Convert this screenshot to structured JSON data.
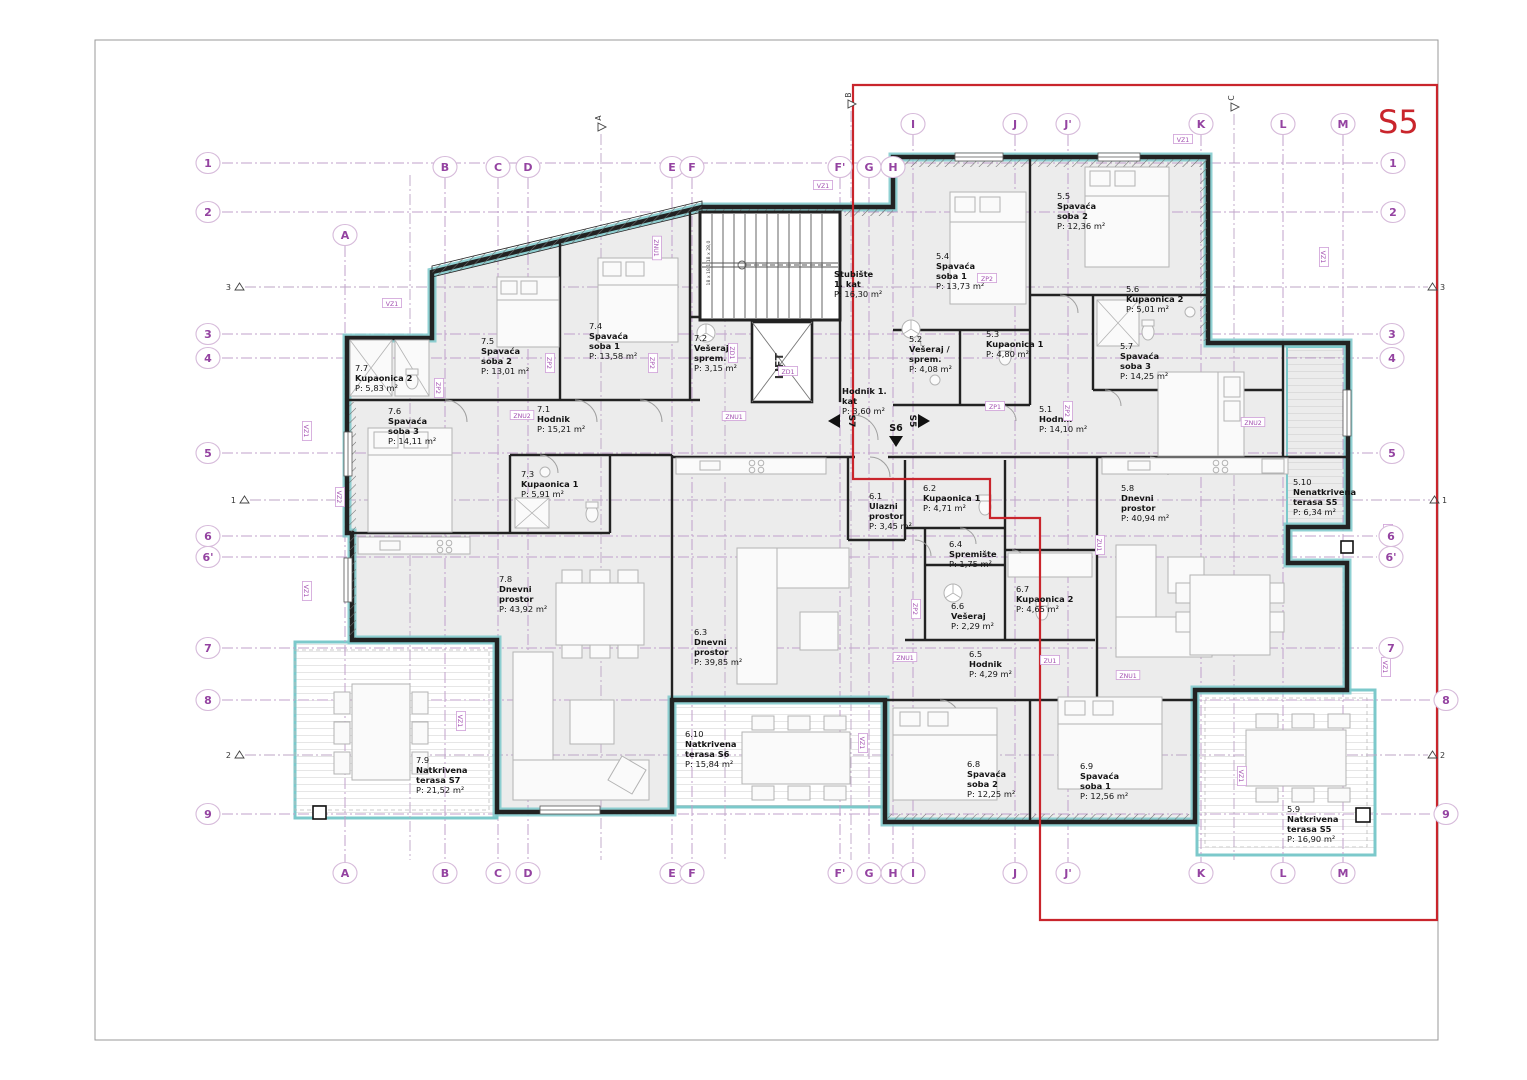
{
  "title": "S5",
  "colors": {
    "boundary": "#c9252c",
    "grid": "#c1a0cb",
    "wall": "#222222",
    "teal": "#7cc9cb",
    "label_purple": "#a24fb0"
  },
  "lift_label": "LIFT",
  "stair_note": "18 x 18,1  18 x 28,0",
  "grid": {
    "bottom_y": 873,
    "columns": [
      {
        "label": "A",
        "x": 345,
        "top": 235
      },
      {
        "label": "B",
        "x": 445,
        "top": 167
      },
      {
        "label": "C",
        "x": 498,
        "top": 167
      },
      {
        "label": "D",
        "x": 528,
        "top": 167
      },
      {
        "label": "E",
        "x": 672,
        "top": 167
      },
      {
        "label": "F",
        "x": 692,
        "top": 167
      },
      {
        "label": "F'",
        "x": 840,
        "top": 167
      },
      {
        "label": "G",
        "x": 869,
        "top": 167
      },
      {
        "label": "H",
        "x": 893,
        "top": 167
      },
      {
        "label": "I",
        "x": 913,
        "top": 124
      },
      {
        "label": "J",
        "x": 1015,
        "top": 124
      },
      {
        "label": "J'",
        "x": 1068,
        "top": 124
      },
      {
        "label": "K",
        "x": 1201,
        "top": 124
      },
      {
        "label": "L",
        "x": 1283,
        "top": 124
      },
      {
        "label": "M",
        "x": 1343,
        "top": 124
      }
    ],
    "rows": [
      {
        "label": "1",
        "y": 163,
        "lx": 208,
        "rx": 1393
      },
      {
        "label": "2",
        "y": 212,
        "lx": 208,
        "rx": 1393
      },
      {
        "label": "3",
        "y": 334,
        "lx": 208,
        "rx": 1392
      },
      {
        "label": "4",
        "y": 358,
        "lx": 208,
        "rx": 1392
      },
      {
        "label": "5",
        "y": 453,
        "lx": 208,
        "rx": 1392
      },
      {
        "label": "6",
        "y": 536,
        "lx": 208,
        "rx": 1391
      },
      {
        "label": "6'",
        "y": 557,
        "lx": 208,
        "rx": 1391
      },
      {
        "label": "7",
        "y": 648,
        "lx": 208,
        "rx": 1391
      },
      {
        "label": "8",
        "y": 700,
        "lx": 208,
        "rx": 1446
      },
      {
        "label": "9",
        "y": 814,
        "lx": 208,
        "rx": 1446
      }
    ]
  },
  "sections": {
    "flags": [
      {
        "label": "A",
        "x": 601,
        "y": 118
      },
      {
        "label": "B",
        "x": 851,
        "y": 95
      },
      {
        "label": "C",
        "x": 1234,
        "y": 98
      }
    ],
    "minor_vlines": [
      {
        "x": 410,
        "y1": 175,
        "y2": 860
      },
      {
        "x": 725,
        "y1": 216,
        "y2": 860
      }
    ],
    "cut_lines": [
      {
        "n": "3",
        "y": 287,
        "x1": 245,
        "x2": 1428
      },
      {
        "n": "1",
        "y": 500,
        "x1": 250,
        "x2": 1430
      },
      {
        "n": "2",
        "y": 755,
        "x1": 245,
        "x2": 1428
      }
    ]
  },
  "apartments": [
    {
      "code": "S7",
      "rooms": [
        {
          "id": "7.7",
          "name": [
            "Kupaonica 2"
          ],
          "area": "P: 5,83 m²",
          "x": 355,
          "y": 371
        },
        {
          "id": "7.6",
          "name": [
            "Spavaća",
            "soba 3"
          ],
          "area": "P: 14,11 m²",
          "x": 388,
          "y": 414
        },
        {
          "id": "7.5",
          "name": [
            "Spavaća",
            "soba 2"
          ],
          "area": "P: 13,01 m²",
          "x": 481,
          "y": 344
        },
        {
          "id": "7.4",
          "name": [
            "Spavaća",
            "soba 1"
          ],
          "area": "P: 13,58 m²",
          "x": 589,
          "y": 329
        },
        {
          "id": "7.2",
          "name": [
            "Vešeraj /",
            "sprem."
          ],
          "area": "P: 3,15 m²",
          "x": 694,
          "y": 341
        },
        {
          "id": "7.1",
          "name": [
            "Hodnik"
          ],
          "area": "P: 15,21 m²",
          "x": 537,
          "y": 412
        },
        {
          "id": "7.3",
          "name": [
            "Kupaonica 1"
          ],
          "area": "P: 5,91 m²",
          "x": 521,
          "y": 477
        },
        {
          "id": "7.8",
          "name": [
            "Dnevni",
            "prostor"
          ],
          "area": "P: 43,92 m²",
          "x": 499,
          "y": 582
        },
        {
          "id": "7.9",
          "name": [
            "Natkrivena",
            "terasa S7"
          ],
          "area": "P: 21,52 m²",
          "x": 416,
          "y": 763
        }
      ]
    },
    {
      "code": "S6",
      "rooms": [
        {
          "id": "6.1",
          "name": [
            "Ulazni",
            "prostor"
          ],
          "area": "P: 3,45 m²",
          "x": 869,
          "y": 499
        },
        {
          "id": "6.2",
          "name": [
            "Kupaonica 1"
          ],
          "area": "P: 4,71 m²",
          "x": 923,
          "y": 491
        },
        {
          "id": "6.4",
          "name": [
            "Spremište"
          ],
          "area": "P: 1,75 m²",
          "x": 949,
          "y": 547
        },
        {
          "id": "6.6",
          "name": [
            "Vešeraj"
          ],
          "area": "P: 2,29 m²",
          "x": 951,
          "y": 609
        },
        {
          "id": "6.7",
          "name": [
            "Kupaonica 2"
          ],
          "area": "P: 4,65 m²",
          "x": 1016,
          "y": 592
        },
        {
          "id": "6.5",
          "name": [
            "Hodnik"
          ],
          "area": "P: 4,29 m²",
          "x": 969,
          "y": 657
        },
        {
          "id": "6.3",
          "name": [
            "Dnevni",
            "prostor"
          ],
          "area": "P: 39,85 m²",
          "x": 694,
          "y": 635
        },
        {
          "id": "6.10",
          "name": [
            "Natkrivena",
            "terasa S6"
          ],
          "area": "P: 15,84 m²",
          "x": 685,
          "y": 737
        },
        {
          "id": "6.8",
          "name": [
            "Spavaća",
            "soba 2"
          ],
          "area": "P: 12,25 m²",
          "x": 967,
          "y": 767
        },
        {
          "id": "6.9",
          "name": [
            "Spavaća",
            "soba 1"
          ],
          "area": "P: 12,56 m²",
          "x": 1080,
          "y": 769
        }
      ]
    },
    {
      "code": "S5",
      "rooms": [
        {
          "id": "5.4",
          "name": [
            "Spavaća",
            "soba 1"
          ],
          "area": "P: 13,73 m²",
          "x": 936,
          "y": 259
        },
        {
          "id": "5.5",
          "name": [
            "Spavaća",
            "soba 2"
          ],
          "area": "P: 12,36 m²",
          "x": 1057,
          "y": 199
        },
        {
          "id": "5.2",
          "name": [
            "Vešeraj /",
            "sprem."
          ],
          "area": "P: 4,08 m²",
          "x": 909,
          "y": 342
        },
        {
          "id": "5.3",
          "name": [
            "Kupaonica 1"
          ],
          "area": "P: 4,80 m²",
          "x": 986,
          "y": 337
        },
        {
          "id": "5.6",
          "name": [
            "Kupaonica 2"
          ],
          "area": "P: 5,01 m²",
          "x": 1126,
          "y": 292
        },
        {
          "id": "5.7",
          "name": [
            "Spavaća",
            "soba 3"
          ],
          "area": "P: 14,25 m²",
          "x": 1120,
          "y": 349
        },
        {
          "id": "5.1",
          "name": [
            "Hodnik"
          ],
          "area": "P: 14,10 m²",
          "x": 1039,
          "y": 412
        },
        {
          "id": "5.8",
          "name": [
            "Dnevni",
            "prostor"
          ],
          "area": "P: 40,94 m²",
          "x": 1121,
          "y": 491
        },
        {
          "id": "5.10",
          "name": [
            "Nenatkrivena",
            "terasa S5"
          ],
          "area": "P: 6,34 m²",
          "x": 1293,
          "y": 485
        },
        {
          "id": "5.9",
          "name": [
            "Natkrivena",
            "terasa S5"
          ],
          "area": "P: 16,90 m²",
          "x": 1287,
          "y": 812
        }
      ]
    },
    {
      "code": "common",
      "rooms": [
        {
          "id": "",
          "name": [
            "Stubište",
            "1. kat"
          ],
          "area": "P: 16,30 m²",
          "x": 834,
          "y": 277
        },
        {
          "id": "",
          "name": [
            "Hodnik 1.",
            "kat"
          ],
          "area": "P: 3,60 m²",
          "x": 842,
          "y": 394
        }
      ]
    }
  ],
  "entry_markers": [
    {
      "label": "S7",
      "dir": "left",
      "x": 838,
      "y": 421
    },
    {
      "label": "S6",
      "dir": "down",
      "x": 896,
      "y": 430
    },
    {
      "label": "S5",
      "dir": "right",
      "x": 916,
      "y": 421
    }
  ],
  "wall_codes": [
    {
      "t": "VZ1",
      "x": 392,
      "y": 305,
      "r": 0
    },
    {
      "t": "VZ1",
      "x": 305,
      "y": 431,
      "r": 90
    },
    {
      "t": "VZ1",
      "x": 305,
      "y": 591,
      "r": 90
    },
    {
      "t": "VZ1",
      "x": 823,
      "y": 187,
      "r": 0
    },
    {
      "t": "VZ1",
      "x": 1183,
      "y": 141,
      "r": 0
    },
    {
      "t": "VZ1",
      "x": 1322,
      "y": 257,
      "r": 90
    },
    {
      "t": "VZ1",
      "x": 459,
      "y": 721,
      "r": 90
    },
    {
      "t": "VZ1",
      "x": 861,
      "y": 743,
      "r": 90
    },
    {
      "t": "VZ1",
      "x": 1386,
      "y": 534,
      "r": 90
    },
    {
      "t": "VZ1",
      "x": 1384,
      "y": 667,
      "r": 90
    },
    {
      "t": "VZ1",
      "x": 1240,
      "y": 776,
      "r": 90
    },
    {
      "t": "VZ2",
      "x": 338,
      "y": 497,
      "r": 90
    },
    {
      "t": "ZNU1",
      "x": 734,
      "y": 418,
      "r": 0
    },
    {
      "t": "ZNU1",
      "x": 905,
      "y": 659,
      "r": 0
    },
    {
      "t": "ZNU1",
      "x": 655,
      "y": 248,
      "r": 90
    },
    {
      "t": "ZNU1",
      "x": 1128,
      "y": 677,
      "r": 0
    },
    {
      "t": "ZNU2",
      "x": 522,
      "y": 417,
      "r": 0
    },
    {
      "t": "ZNU2",
      "x": 1253,
      "y": 424,
      "r": 0
    },
    {
      "t": "ZP2",
      "x": 548,
      "y": 363,
      "r": 90
    },
    {
      "t": "ZP2",
      "x": 651,
      "y": 363,
      "r": 90
    },
    {
      "t": "ZP2",
      "x": 987,
      "y": 280,
      "r": 0
    },
    {
      "t": "ZP2",
      "x": 914,
      "y": 609,
      "r": 90
    },
    {
      "t": "ZP2",
      "x": 1066,
      "y": 411,
      "r": 90
    },
    {
      "t": "ZP2",
      "x": 437,
      "y": 388,
      "r": 90
    },
    {
      "t": "ZP1",
      "x": 995,
      "y": 408,
      "r": 0
    },
    {
      "t": "ZD1",
      "x": 788,
      "y": 373,
      "r": 0
    },
    {
      "t": "ZD1",
      "x": 731,
      "y": 353,
      "r": 90
    },
    {
      "t": "ZU1",
      "x": 1050,
      "y": 662,
      "r": 0
    },
    {
      "t": "ZU1",
      "x": 1098,
      "y": 545,
      "r": 90
    }
  ]
}
